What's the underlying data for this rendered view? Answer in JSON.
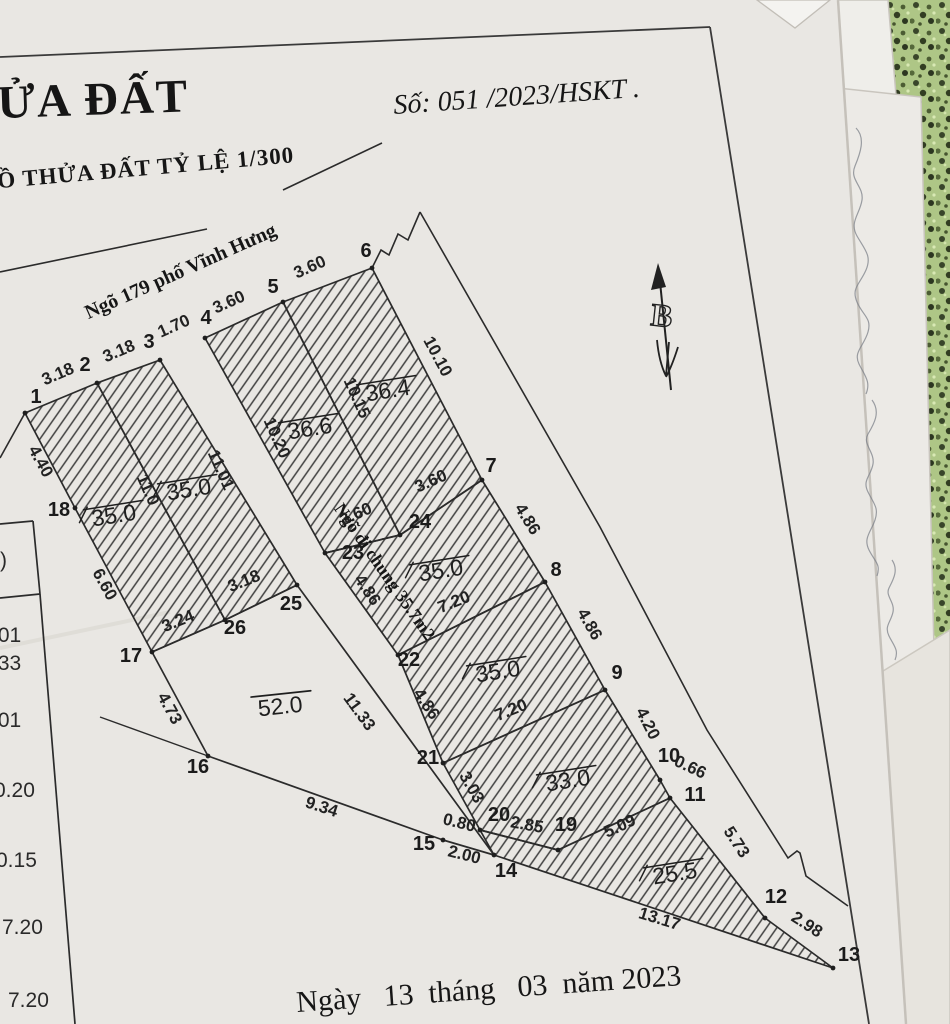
{
  "page": {
    "title": "ỬA ĐẤT",
    "doc_no": "Số: 051 /2023/HSKT .",
    "subtitle": "Ồ THỬA ĐẤT TỶ LỆ 1/300",
    "date": "Ngày   13  tháng   03  năm 2023",
    "north": "B"
  },
  "map": {
    "street": "Ngõ 179 phố Vĩnh Hưng",
    "alley": "Ngõ đi chung 35.7m2",
    "points": {
      "1": "1",
      "2": "2",
      "3": "3",
      "4": "4",
      "5": "5",
      "6": "6",
      "7": "7",
      "8": "8",
      "9": "9",
      "10": "10",
      "11": "11",
      "12": "12",
      "13": "13",
      "14": "14",
      "15": "15",
      "16": "16",
      "17": "17",
      "18": "18",
      "19": "19",
      "20": "20",
      "21": "21",
      "22": "22",
      "23": "23",
      "24": "24",
      "25": "25",
      "26": "26"
    },
    "dims": {
      "s12": "3.18",
      "s23": "3.18",
      "s34": "1.70",
      "s45": "3.60",
      "s56": "3.60",
      "e67": "10.10",
      "e78": "4.86",
      "e89": "4.86",
      "e910": "4.20",
      "e1011": "0.66",
      "e1112": "5.73",
      "e1213": "2.98",
      "b1314": "13.17",
      "b1415": "2.00",
      "b1516": "9.34",
      "b1617": "4.73",
      "b1718": "6.60",
      "b181": "4.40",
      "i226": "11.0",
      "i325": "11.01",
      "i423": "10.20",
      "i524": "10.15",
      "i1726": "3.24",
      "i2625": "3.18",
      "i2324": "3.60",
      "i247": "3.60",
      "p2322": "4.86",
      "p2221": "4.86",
      "p2514": "11.33",
      "p2120": "3.03",
      "c228": "7.20",
      "c219": "7.20",
      "f2019": "2.85",
      "f1420": "0.80",
      "f1911": "5.09"
    },
    "areas": {
      "plot_a": "35.0",
      "plot_b": "35.0",
      "plot_c": "36.6",
      "plot_d": "36.4",
      "plot_e": "35.0",
      "plot_f": "35.0",
      "plot_g": "33.0",
      "plot_h": "25.5",
      "plot_52": "52.0"
    },
    "side_table": {
      "header": ")",
      "rows": [
        ".01",
        ".33",
        ".01",
        "0.20",
        "0.15",
        "7.20",
        "7.20"
      ]
    }
  }
}
